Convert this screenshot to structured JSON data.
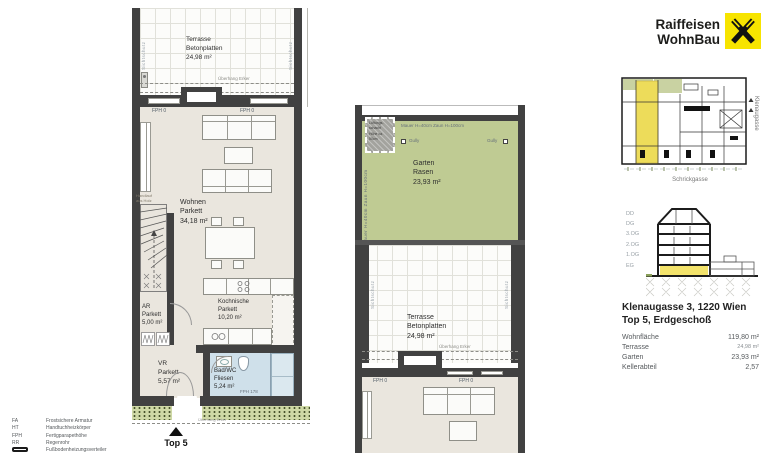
{
  "logo": {
    "line1": "Raiffeisen",
    "line2": "WohnBau"
  },
  "plan": {
    "rooms": {
      "terrasse": {
        "name": "Terrasse",
        "surface": "Betonplatten",
        "area": "24,98 m²"
      },
      "wohnen": {
        "name": "Wohnen",
        "surface": "Parkett",
        "area": "34,18 m²"
      },
      "kochnische": {
        "name": "Kochnische",
        "surface": "Parkett",
        "area": "10,20 m²"
      },
      "ar": {
        "name": "AR",
        "surface": "Parkett",
        "area": "5,00 m²"
      },
      "vr": {
        "name": "VR",
        "surface": "Parkett",
        "area": "5,57 m²"
      },
      "badwc": {
        "name": "Bad/WC",
        "surface": "Fliesen",
        "area": "5,24 m²"
      },
      "garten": {
        "name": "Garten",
        "surface": "Rasen",
        "area": "23,93 m²"
      }
    },
    "annotations": {
      "fph0": "FPH 0",
      "fph178": "FPH 178",
      "sichtschutz": "Sichtschutz",
      "ueberhang": "Überhang Erker",
      "handlauf1": "Handlauf",
      "handlauf2": "aus Holz",
      "mauer_zaun": "Mauer H=40cm   Zaun H=100cm",
      "gully": "Gully",
      "lueft1": "Lüftungs-",
      "lueft2": "schacht",
      "lueft3": "Höhe ca.",
      "lueft4": "50cm",
      "top_marker": "Top 5"
    }
  },
  "site_plan": {
    "street_bottom": "Schrickgasse",
    "street_right": "Klenaugasse"
  },
  "section": {
    "levels": [
      "DD",
      "DG",
      "3.OG",
      "2.OG",
      "1.OG",
      "EG"
    ]
  },
  "info": {
    "title1": "Klenaugasse 3, 1220 Wien",
    "title2": "Top 5, Erdgeschoß",
    "rows": [
      {
        "label": "Wohnfläche",
        "value": "119,80 m²"
      },
      {
        "label": "Terrasse",
        "value": "24,98 m²"
      },
      {
        "label": "Garten",
        "value": "23,93 m²"
      },
      {
        "label": "Kellerabteil",
        "value": "2,57"
      }
    ]
  },
  "legend": {
    "items": [
      {
        "abbr": "FA",
        "desc": "Frostsichere Armatur"
      },
      {
        "abbr": "HT",
        "desc": "Handtuchheizkörper"
      },
      {
        "abbr": "FPH",
        "desc": "Fertigparapethöhe"
      },
      {
        "abbr": "RR",
        "desc": "Regenrohr"
      },
      {
        "abbr": "",
        "desc": "Fußbodenheizungsverteiler"
      }
    ]
  },
  "colors": {
    "accent_yellow": "#f7e400",
    "garden_green": "#bfcb93",
    "bath_blue": "#cfe0ea",
    "highlight_yellow": "#eddc5a"
  }
}
